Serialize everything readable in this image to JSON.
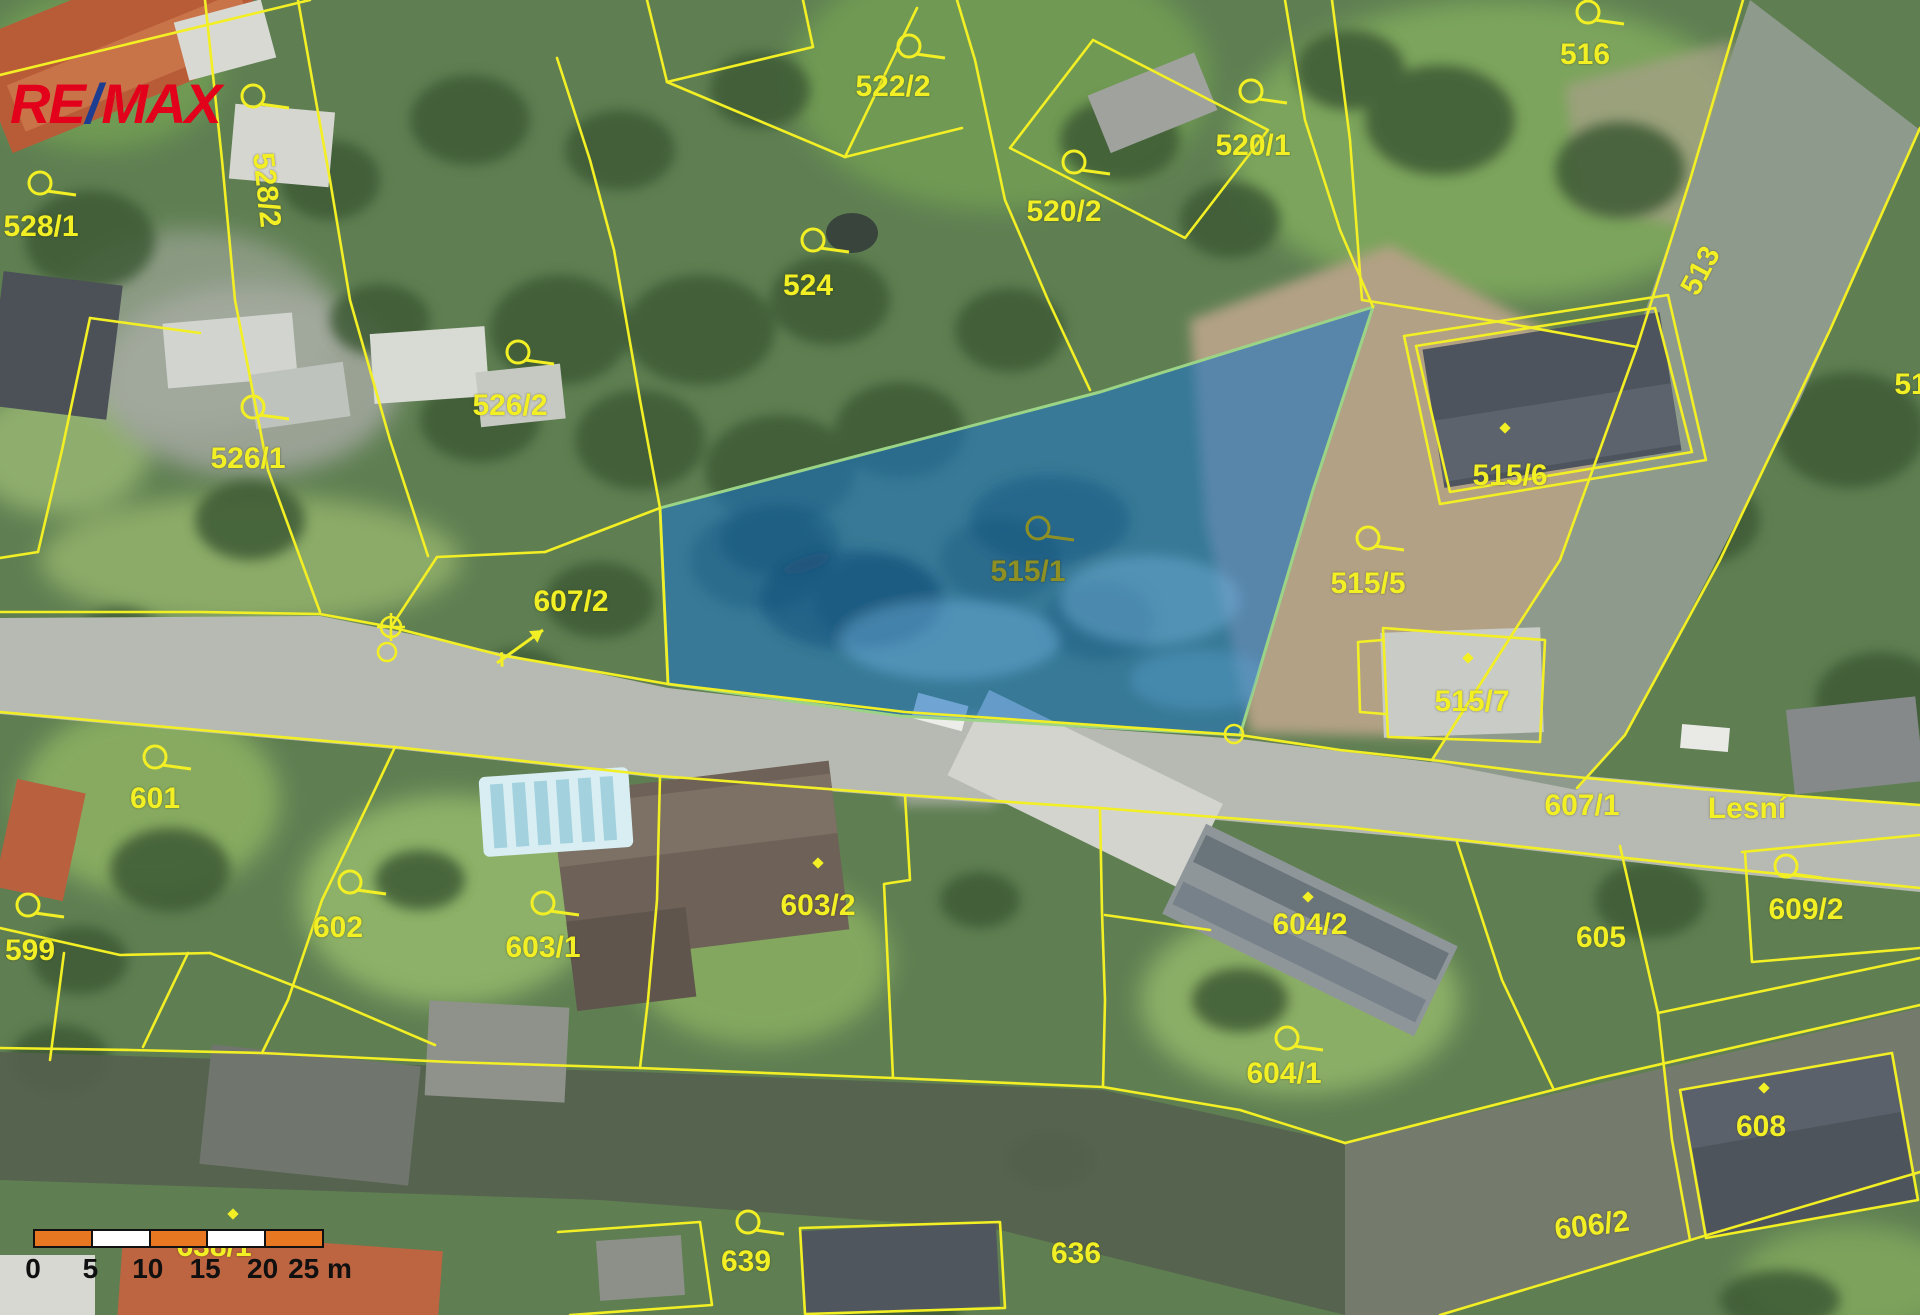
{
  "logo": {
    "re": "RE",
    "slash": "/",
    "max": "MAX"
  },
  "scale_bar": {
    "segment_colors": [
      "#e87722",
      "#ffffff",
      "#e87722",
      "#ffffff",
      "#e87722"
    ],
    "labels": [
      "0",
      "5",
      "10",
      "15",
      "20",
      "25 m"
    ]
  },
  "map": {
    "parcel_line_color": "#f3ef25",
    "highlight_parcel": "515/1",
    "highlight_fill": "#1d74c4",
    "highlight_outline": "#9bd487",
    "street_name": "Lesní",
    "labels": [
      {
        "text": "528/1",
        "x": 41,
        "y": 227
      },
      {
        "text": "528/2",
        "x": 266,
        "y": 190,
        "rot": 84
      },
      {
        "text": "526/1",
        "x": 248,
        "y": 459
      },
      {
        "text": "526/2",
        "x": 510,
        "y": 406
      },
      {
        "text": "524",
        "x": 808,
        "y": 286
      },
      {
        "text": "522/2",
        "x": 893,
        "y": 87
      },
      {
        "text": "520/2",
        "x": 1064,
        "y": 212
      },
      {
        "text": "520/1",
        "x": 1253,
        "y": 146
      },
      {
        "text": "516",
        "x": 1585,
        "y": 55
      },
      {
        "text": "513",
        "x": 1701,
        "y": 271,
        "rot": -62
      },
      {
        "text": "51",
        "x": 1911,
        "y": 385
      },
      {
        "text": "515/6",
        "x": 1510,
        "y": 476
      },
      {
        "text": "515/5",
        "x": 1368,
        "y": 584
      },
      {
        "text": "515/1",
        "x": 1028,
        "y": 572,
        "color": "#8e9023"
      },
      {
        "text": "515/7",
        "x": 1472,
        "y": 702
      },
      {
        "text": "607/2",
        "x": 571,
        "y": 602
      },
      {
        "text": "607/1",
        "x": 1582,
        "y": 806
      },
      {
        "text": "Lesní",
        "x": 1747,
        "y": 809
      },
      {
        "text": "601",
        "x": 155,
        "y": 799
      },
      {
        "text": "602",
        "x": 338,
        "y": 928
      },
      {
        "text": "603/1",
        "x": 543,
        "y": 948
      },
      {
        "text": "603/2",
        "x": 818,
        "y": 906
      },
      {
        "text": "604/2",
        "x": 1310,
        "y": 925
      },
      {
        "text": "604/1",
        "x": 1284,
        "y": 1074
      },
      {
        "text": "605",
        "x": 1601,
        "y": 938
      },
      {
        "text": "599",
        "x": 30,
        "y": 951
      },
      {
        "text": "608",
        "x": 1761,
        "y": 1127
      },
      {
        "text": "609/2",
        "x": 1806,
        "y": 910
      },
      {
        "text": "636",
        "x": 1076,
        "y": 1254
      },
      {
        "text": "639",
        "x": 746,
        "y": 1262
      },
      {
        "text": "606/2",
        "x": 1592,
        "y": 1226,
        "rot": -7
      },
      {
        "text": "638/1",
        "x": 214,
        "y": 1247,
        "z": 2
      }
    ],
    "symbols": [
      {
        "type": "flag",
        "x": 40,
        "y": 183
      },
      {
        "type": "flag",
        "x": 253,
        "y": 96
      },
      {
        "type": "flag",
        "x": 253,
        "y": 407
      },
      {
        "type": "flag",
        "x": 518,
        "y": 352
      },
      {
        "type": "flag",
        "x": 813,
        "y": 240
      },
      {
        "type": "flag",
        "x": 909,
        "y": 46
      },
      {
        "type": "flag",
        "x": 1074,
        "y": 162
      },
      {
        "type": "flag",
        "x": 1251,
        "y": 91
      },
      {
        "type": "flag",
        "x": 1588,
        "y": 12
      },
      {
        "type": "flag",
        "x": 1368,
        "y": 538
      },
      {
        "type": "flag",
        "x": 1038,
        "y": 528,
        "color": "#8e9023"
      },
      {
        "type": "flag",
        "x": 155,
        "y": 757
      },
      {
        "type": "flag",
        "x": 350,
        "y": 882
      },
      {
        "type": "flag",
        "x": 543,
        "y": 903
      },
      {
        "type": "flag",
        "x": 1287,
        "y": 1038
      },
      {
        "type": "flag",
        "x": 748,
        "y": 1222
      },
      {
        "type": "flag",
        "x": 1786,
        "y": 866
      },
      {
        "type": "flag",
        "x": 28,
        "y": 905
      },
      {
        "type": "dot",
        "x": 1505,
        "y": 428
      },
      {
        "type": "dot",
        "x": 1468,
        "y": 658
      },
      {
        "type": "dot",
        "x": 818,
        "y": 863
      },
      {
        "type": "dot",
        "x": 1308,
        "y": 897
      },
      {
        "type": "dot",
        "x": 1764,
        "y": 1088
      },
      {
        "type": "dot",
        "x": 233,
        "y": 1214
      },
      {
        "type": "circle-cross",
        "x": 391,
        "y": 627
      },
      {
        "type": "circle",
        "x": 387,
        "y": 652
      },
      {
        "type": "circle",
        "x": 1234,
        "y": 734
      },
      {
        "type": "arrow",
        "x": 497,
        "y": 663,
        "x2": 543,
        "y2": 630
      }
    ]
  }
}
